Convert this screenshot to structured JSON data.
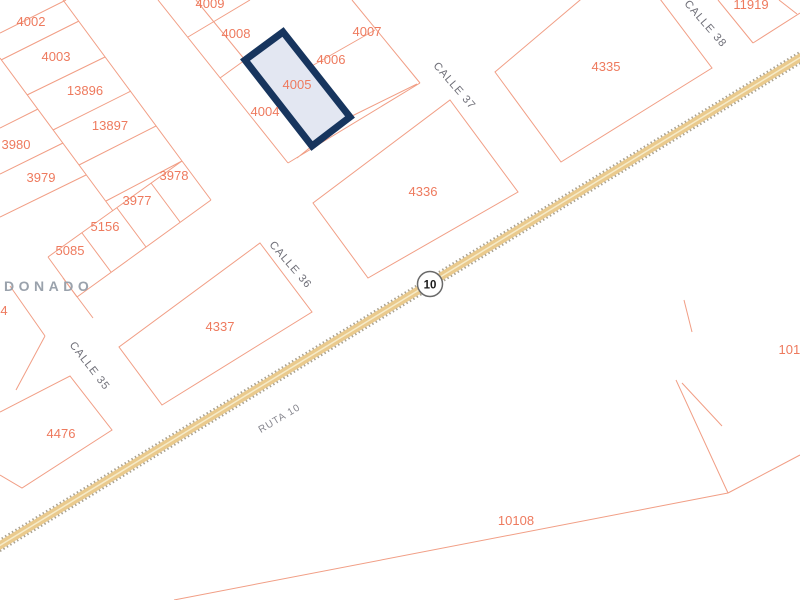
{
  "map": {
    "title": "cadastral-parcel-map",
    "colors": {
      "background": "#ffffff",
      "parcel_line": "#f19e85",
      "parcel_label": "#ee7a5e",
      "highlight_border": "#17355e",
      "highlight_fill": "#e3e7f2",
      "road_fill": "#eaca8d",
      "road_edge": "#9c937f",
      "road_center": "#f6ebc8",
      "street_label": "#6f6f78",
      "city_label": "#9aa2ac",
      "shield_border": "#6a6a6a"
    },
    "highlighted_parcel": {
      "label": "4005",
      "points": "283,32 350,117 312,146 245,60",
      "label_x": 297,
      "label_y": 89
    },
    "parcels": [
      {
        "label": "4002",
        "x": 31,
        "y": 26
      },
      {
        "label": "4003",
        "x": 56,
        "y": 61
      },
      {
        "label": "13896",
        "x": 85,
        "y": 95
      },
      {
        "label": "13897",
        "x": 110,
        "y": 130
      },
      {
        "label": "3980",
        "x": 16,
        "y": 149
      },
      {
        "label": "3979",
        "x": 41,
        "y": 182
      },
      {
        "label": "3978",
        "x": 174,
        "y": 180
      },
      {
        "label": "3977",
        "x": 137,
        "y": 205
      },
      {
        "label": "5156",
        "x": 105,
        "y": 231
      },
      {
        "label": "5085",
        "x": 70,
        "y": 255
      },
      {
        "label": "4",
        "x": 4,
        "y": 315
      },
      {
        "label": "4476",
        "x": 61,
        "y": 438
      },
      {
        "label": "4337",
        "x": 220,
        "y": 331
      },
      {
        "label": "4009",
        "x": 210,
        "y": 8
      },
      {
        "label": "4008",
        "x": 236,
        "y": 38
      },
      {
        "label": "4007",
        "x": 367,
        "y": 36
      },
      {
        "label": "4006",
        "x": 331,
        "y": 64
      },
      {
        "label": "4004",
        "x": 265,
        "y": 116
      },
      {
        "label": "4336",
        "x": 423,
        "y": 196
      },
      {
        "label": "4335",
        "x": 606,
        "y": 71
      },
      {
        "label": "11919",
        "x": 751,
        "y": 9
      },
      {
        "label": "10108",
        "x": 516,
        "y": 525
      },
      {
        "label": "1010",
        "x": 793,
        "y": 354
      }
    ],
    "streets": [
      {
        "label": "CALLE 38",
        "x": 703,
        "y": 26,
        "rotation": 49
      },
      {
        "label": "CALLE 37",
        "x": 452,
        "y": 88,
        "rotation": 49
      },
      {
        "label": "CALLE 36",
        "x": 288,
        "y": 267,
        "rotation": 49
      },
      {
        "label": "CALLE 35",
        "x": 87,
        "y": 368,
        "rotation": 52
      }
    ],
    "route_label": {
      "text": "RUTA 10",
      "x": 281,
      "y": 421,
      "rotation": -31
    },
    "route_shield": {
      "text": "10"
    },
    "city_label": {
      "text": "LDONADO"
    }
  }
}
